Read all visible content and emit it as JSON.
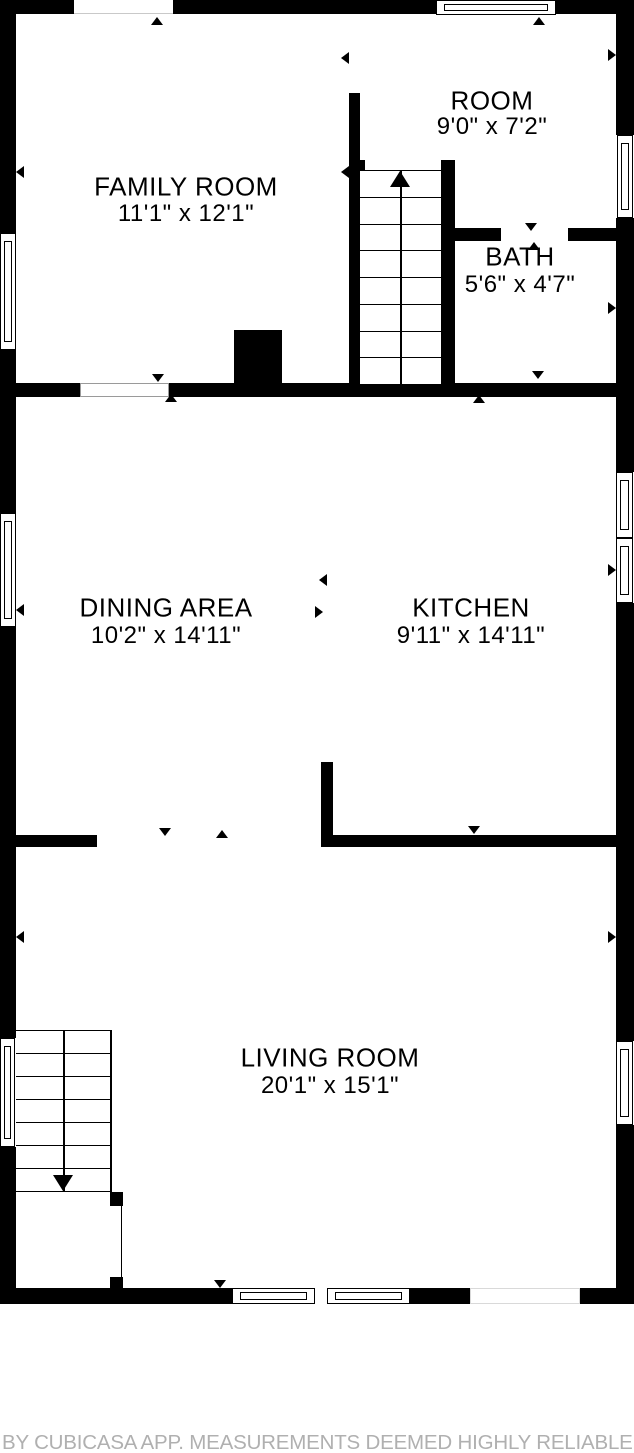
{
  "plan": {
    "colors": {
      "wall": "#000000",
      "background": "#ffffff",
      "footer_text": "#b0b0b0"
    },
    "rooms": [
      {
        "id": "family-room",
        "name": "FAMILY ROOM",
        "dimensions": "11'1\" x 12'1\"",
        "cx": 186,
        "name_y": 187,
        "dims_y": 214
      },
      {
        "id": "room",
        "name": "ROOM",
        "dimensions": "9'0\" x 7'2\"",
        "cx": 492,
        "name_y": 101,
        "dims_y": 127
      },
      {
        "id": "bath",
        "name": "BATH",
        "dimensions": "5'6\" x 4'7\"",
        "cx": 520,
        "name_y": 257,
        "dims_y": 285
      },
      {
        "id": "dining-area",
        "name": "DINING AREA",
        "dimensions": "10'2\" x 14'11\"",
        "cx": 166,
        "name_y": 608,
        "dims_y": 636
      },
      {
        "id": "kitchen",
        "name": "KITCHEN",
        "dimensions": "9'11\" x 14'11\"",
        "cx": 471,
        "name_y": 608,
        "dims_y": 636
      },
      {
        "id": "living-room",
        "name": "LIVING ROOM",
        "dimensions": "20'1\" x 15'1\"",
        "cx": 330,
        "name_y": 1058,
        "dims_y": 1086
      }
    ],
    "walls": [
      {
        "id": "top-wall-left",
        "x": 0,
        "y": 0,
        "w": 74,
        "h": 14
      },
      {
        "id": "top-wall-mid",
        "x": 173,
        "y": 0,
        "w": 263,
        "h": 14
      },
      {
        "id": "top-wall-right",
        "x": 556,
        "y": 0,
        "w": 78,
        "h": 14
      },
      {
        "id": "left-wall-upper",
        "x": 0,
        "y": 0,
        "w": 16,
        "h": 233
      },
      {
        "id": "left-wall-mid1",
        "x": 0,
        "y": 350,
        "w": 16,
        "h": 163
      },
      {
        "id": "left-wall-mid2",
        "x": 0,
        "y": 627,
        "w": 16,
        "h": 411
      },
      {
        "id": "left-wall-lower",
        "x": 0,
        "y": 1147,
        "w": 16,
        "h": 157
      },
      {
        "id": "right-wall-upper",
        "x": 616,
        "y": 0,
        "w": 18,
        "h": 135
      },
      {
        "id": "right-wall-mid1",
        "x": 616,
        "y": 218,
        "w": 18,
        "h": 254
      },
      {
        "id": "right-wall-mid2",
        "x": 616,
        "y": 603,
        "w": 18,
        "h": 438
      },
      {
        "id": "right-wall-lower",
        "x": 616,
        "y": 1125,
        "w": 18,
        "h": 179
      },
      {
        "id": "bottom-wall-left",
        "x": 0,
        "y": 1288,
        "w": 232,
        "h": 16
      },
      {
        "id": "bottom-wall-mid",
        "x": 410,
        "y": 1288,
        "w": 60,
        "h": 16
      },
      {
        "id": "bottom-wall-right",
        "x": 580,
        "y": 1288,
        "w": 54,
        "h": 16
      },
      {
        "id": "family-dining-wall-left",
        "x": 16,
        "y": 383,
        "w": 64,
        "h": 14
      },
      {
        "id": "family-dining-wall-right",
        "x": 169,
        "y": 383,
        "w": 447,
        "h": 14
      },
      {
        "id": "chimney",
        "x": 234,
        "y": 330,
        "w": 48,
        "h": 67
      },
      {
        "id": "stair-left-wall",
        "x": 349,
        "y": 93,
        "w": 11,
        "h": 292
      },
      {
        "id": "stair-left-notch",
        "x": 349,
        "y": 160,
        "w": 16,
        "h": 11
      },
      {
        "id": "stair-right-wall",
        "x": 441,
        "y": 160,
        "w": 14,
        "h": 225
      },
      {
        "id": "bath-top-wall-left",
        "x": 441,
        "y": 228,
        "w": 60,
        "h": 13
      },
      {
        "id": "bath-top-wall-right",
        "x": 568,
        "y": 228,
        "w": 48,
        "h": 13
      },
      {
        "id": "kitchen-wall-vertical",
        "x": 321,
        "y": 762,
        "w": 12,
        "h": 85
      },
      {
        "id": "kitchen-wall-bottom",
        "x": 321,
        "y": 835,
        "w": 295,
        "h": 12
      },
      {
        "id": "dining-wall-bottom",
        "x": 16,
        "y": 835,
        "w": 81,
        "h": 12
      },
      {
        "id": "stair2-post-upper",
        "x": 110,
        "y": 1192,
        "w": 13,
        "h": 14
      },
      {
        "id": "stair2-post-lower",
        "x": 110,
        "y": 1277,
        "w": 13,
        "h": 14
      }
    ],
    "windows": [
      {
        "id": "window-top-room",
        "x": 436,
        "y": 0,
        "w": 120,
        "h": 15,
        "dir": "h"
      },
      {
        "id": "window-right-room",
        "x": 617,
        "y": 135,
        "w": 16,
        "h": 83,
        "dir": "v"
      },
      {
        "id": "window-right-kitchen-upper",
        "x": 616,
        "y": 472,
        "w": 17,
        "h": 66,
        "dir": "v"
      },
      {
        "id": "window-right-kitchen-lower",
        "x": 616,
        "y": 538,
        "w": 17,
        "h": 65,
        "dir": "v"
      },
      {
        "id": "window-left-family",
        "x": 0,
        "y": 233,
        "w": 16,
        "h": 117,
        "dir": "v"
      },
      {
        "id": "window-left-dining",
        "x": 0,
        "y": 513,
        "w": 16,
        "h": 114,
        "dir": "v"
      },
      {
        "id": "window-left-stairs",
        "x": 0,
        "y": 1038,
        "w": 15,
        "h": 109,
        "dir": "v"
      },
      {
        "id": "window-bottom-left",
        "x": 232,
        "y": 1288,
        "w": 83,
        "h": 16,
        "dir": "h"
      },
      {
        "id": "window-bottom-right",
        "x": 327,
        "y": 1288,
        "w": 83,
        "h": 16,
        "dir": "h"
      },
      {
        "id": "window-right-living",
        "x": 616,
        "y": 1041,
        "w": 17,
        "h": 84,
        "dir": "v"
      }
    ],
    "openings": [
      {
        "id": "opening-family-top",
        "x": 74,
        "y": 0,
        "w": 99,
        "h": 14,
        "style": "bottomline"
      },
      {
        "id": "opening-family-dining",
        "x": 80,
        "y": 383,
        "w": 89,
        "h": 14,
        "style": "box"
      },
      {
        "id": "opening-bath-door",
        "x": 501,
        "y": 228,
        "w": 67,
        "h": 13,
        "style": "plain"
      },
      {
        "id": "opening-living-bottom",
        "x": 470,
        "y": 1288,
        "w": 110,
        "h": 16,
        "style": "faint"
      },
      {
        "id": "opening-basement-stairs",
        "x": 110,
        "y": 1206,
        "w": 13,
        "h": 71,
        "style": "plain"
      }
    ],
    "stairs": [
      {
        "id": "staircase-main",
        "x": 360,
        "y": 170,
        "w": 81,
        "h": 215,
        "steps": 8,
        "dir": "up",
        "line_x": 400
      },
      {
        "id": "staircase-basement",
        "x": 16,
        "y": 1030,
        "w": 94,
        "h": 162,
        "steps": 7,
        "dir": "down",
        "line_x": 63
      }
    ],
    "arrows": [
      {
        "x": 157,
        "y": 17,
        "dir": "up"
      },
      {
        "x": 539,
        "y": 17,
        "dir": "up"
      },
      {
        "x": 341,
        "y": 58,
        "dir": "left"
      },
      {
        "x": 616,
        "y": 55,
        "dir": "right"
      },
      {
        "x": 16,
        "y": 172,
        "dir": "left"
      },
      {
        "x": 341,
        "y": 172,
        "dir": "left"
      },
      {
        "x": 531,
        "y": 231,
        "dir": "down"
      },
      {
        "x": 534,
        "y": 242,
        "dir": "up"
      },
      {
        "x": 447,
        "y": 308,
        "dir": "left"
      },
      {
        "x": 616,
        "y": 308,
        "dir": "right"
      },
      {
        "x": 158,
        "y": 382,
        "dir": "down"
      },
      {
        "x": 171,
        "y": 394,
        "dir": "up"
      },
      {
        "x": 479,
        "y": 395,
        "dir": "up"
      },
      {
        "x": 538,
        "y": 379,
        "dir": "down"
      },
      {
        "x": 16,
        "y": 610,
        "dir": "left"
      },
      {
        "x": 616,
        "y": 570,
        "dir": "right"
      },
      {
        "x": 319,
        "y": 580,
        "dir": "left"
      },
      {
        "x": 323,
        "y": 612,
        "dir": "right"
      },
      {
        "x": 165,
        "y": 836,
        "dir": "down"
      },
      {
        "x": 222,
        "y": 830,
        "dir": "up"
      },
      {
        "x": 474,
        "y": 834,
        "dir": "down"
      },
      {
        "x": 16,
        "y": 937,
        "dir": "left"
      },
      {
        "x": 616,
        "y": 937,
        "dir": "right"
      },
      {
        "x": 220,
        "y": 1288,
        "dir": "down"
      }
    ],
    "extra_lines": [
      {
        "id": "stair2-rail",
        "x": 110,
        "y": 1030,
        "w": 2,
        "h": 162
      },
      {
        "id": "basement-door-line",
        "x": 121,
        "y": 1206,
        "w": 1,
        "h": 71
      }
    ]
  },
  "footer": {
    "credit": "BY CUBICASA APP. MEASUREMENTS DEEMED HIGHLY RELIABLE B"
  }
}
